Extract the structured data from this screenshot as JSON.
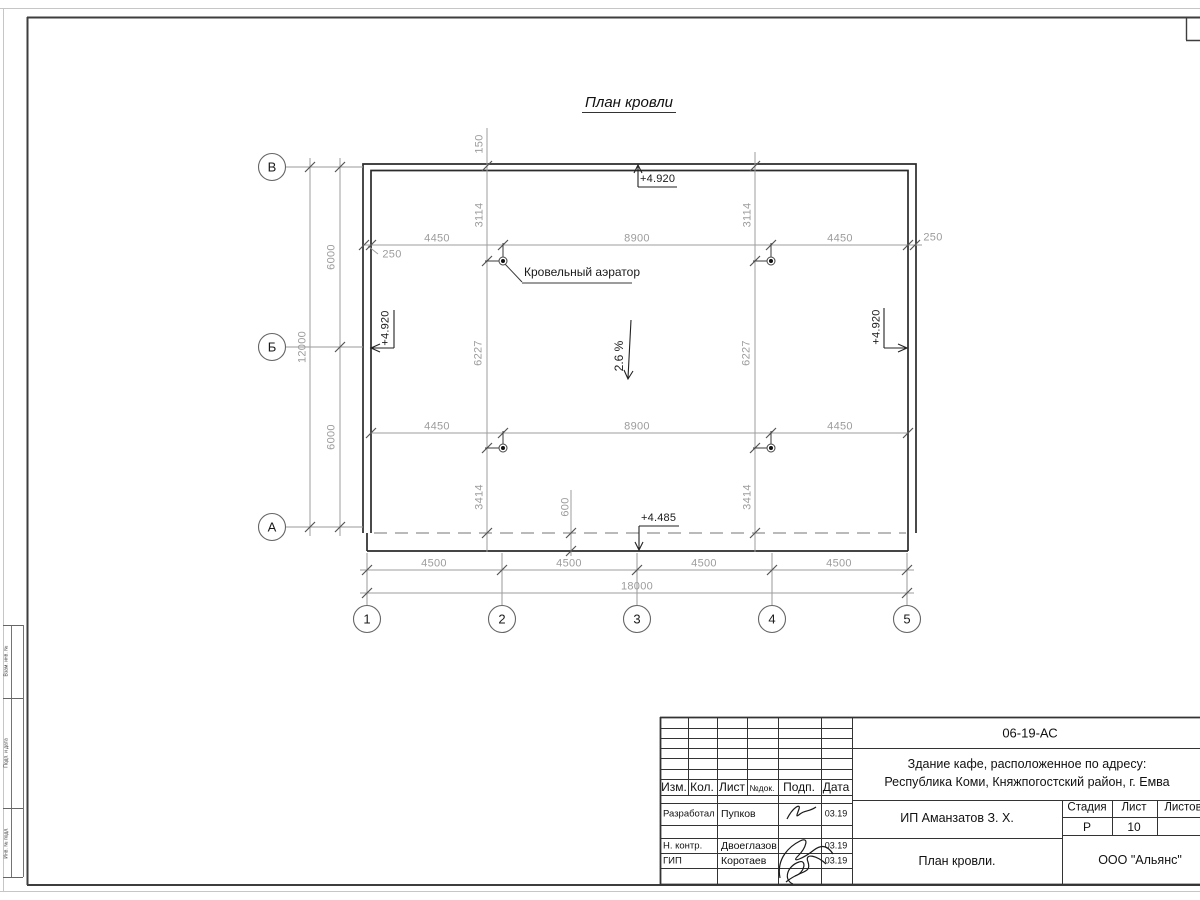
{
  "sheet": {
    "left_margin": [
      "Взам. инв. №",
      "Подп. и дата",
      "Инв. № подл."
    ]
  },
  "plan": {
    "title": "План кровли",
    "aerator_label": "Кровельный аэратор",
    "slope": "2.6 %",
    "elev_top": "+4.920",
    "elev_left": "+4.920",
    "elev_right": "+4.920",
    "elev_bottom": "+4.485",
    "axes_h": [
      "В",
      "Б",
      "А"
    ],
    "axes_v": [
      "1",
      "2",
      "3",
      "4",
      "5"
    ],
    "dims": {
      "top": [
        "4450",
        "8900",
        "4450"
      ],
      "top_left": "250",
      "top_right": "250",
      "mid": [
        "4450",
        "8900",
        "4450"
      ],
      "bottom": [
        "4500",
        "4500",
        "4500",
        "4500"
      ],
      "total_w": "18000",
      "left": [
        "6000",
        "6000"
      ],
      "total_h": "12000",
      "colL": [
        "150",
        "3114",
        "6227",
        "3414"
      ],
      "colR": [
        "3114",
        "6227",
        "3414"
      ],
      "overhang": "600"
    }
  },
  "title_block": {
    "doc_number": "06-19-АС",
    "project_line1": "Здание кафе, расположенное по адресу:",
    "project_line2": "Республика Коми, Княжпогостский район, г. Емва",
    "client": "ИП Аманзатов З. Х.",
    "drawing_name": "План кровли.",
    "company": "ООО \"Альянс\"",
    "cols": [
      "Изм.",
      "Кол.",
      "Лист",
      "№док.",
      "Подп.",
      "Дата"
    ],
    "stage_cols": [
      "Стадия",
      "Лист",
      "Листов"
    ],
    "stage": "Р",
    "sheet": "10",
    "rows": [
      {
        "role": "Разработал",
        "name": "Пупков",
        "date": "03.19"
      },
      {
        "role": "Н. контр.",
        "name": "Двоеглазов",
        "date": "03.19"
      },
      {
        "role": "ГИП",
        "name": "Коротаев",
        "date": "03.19"
      }
    ]
  }
}
